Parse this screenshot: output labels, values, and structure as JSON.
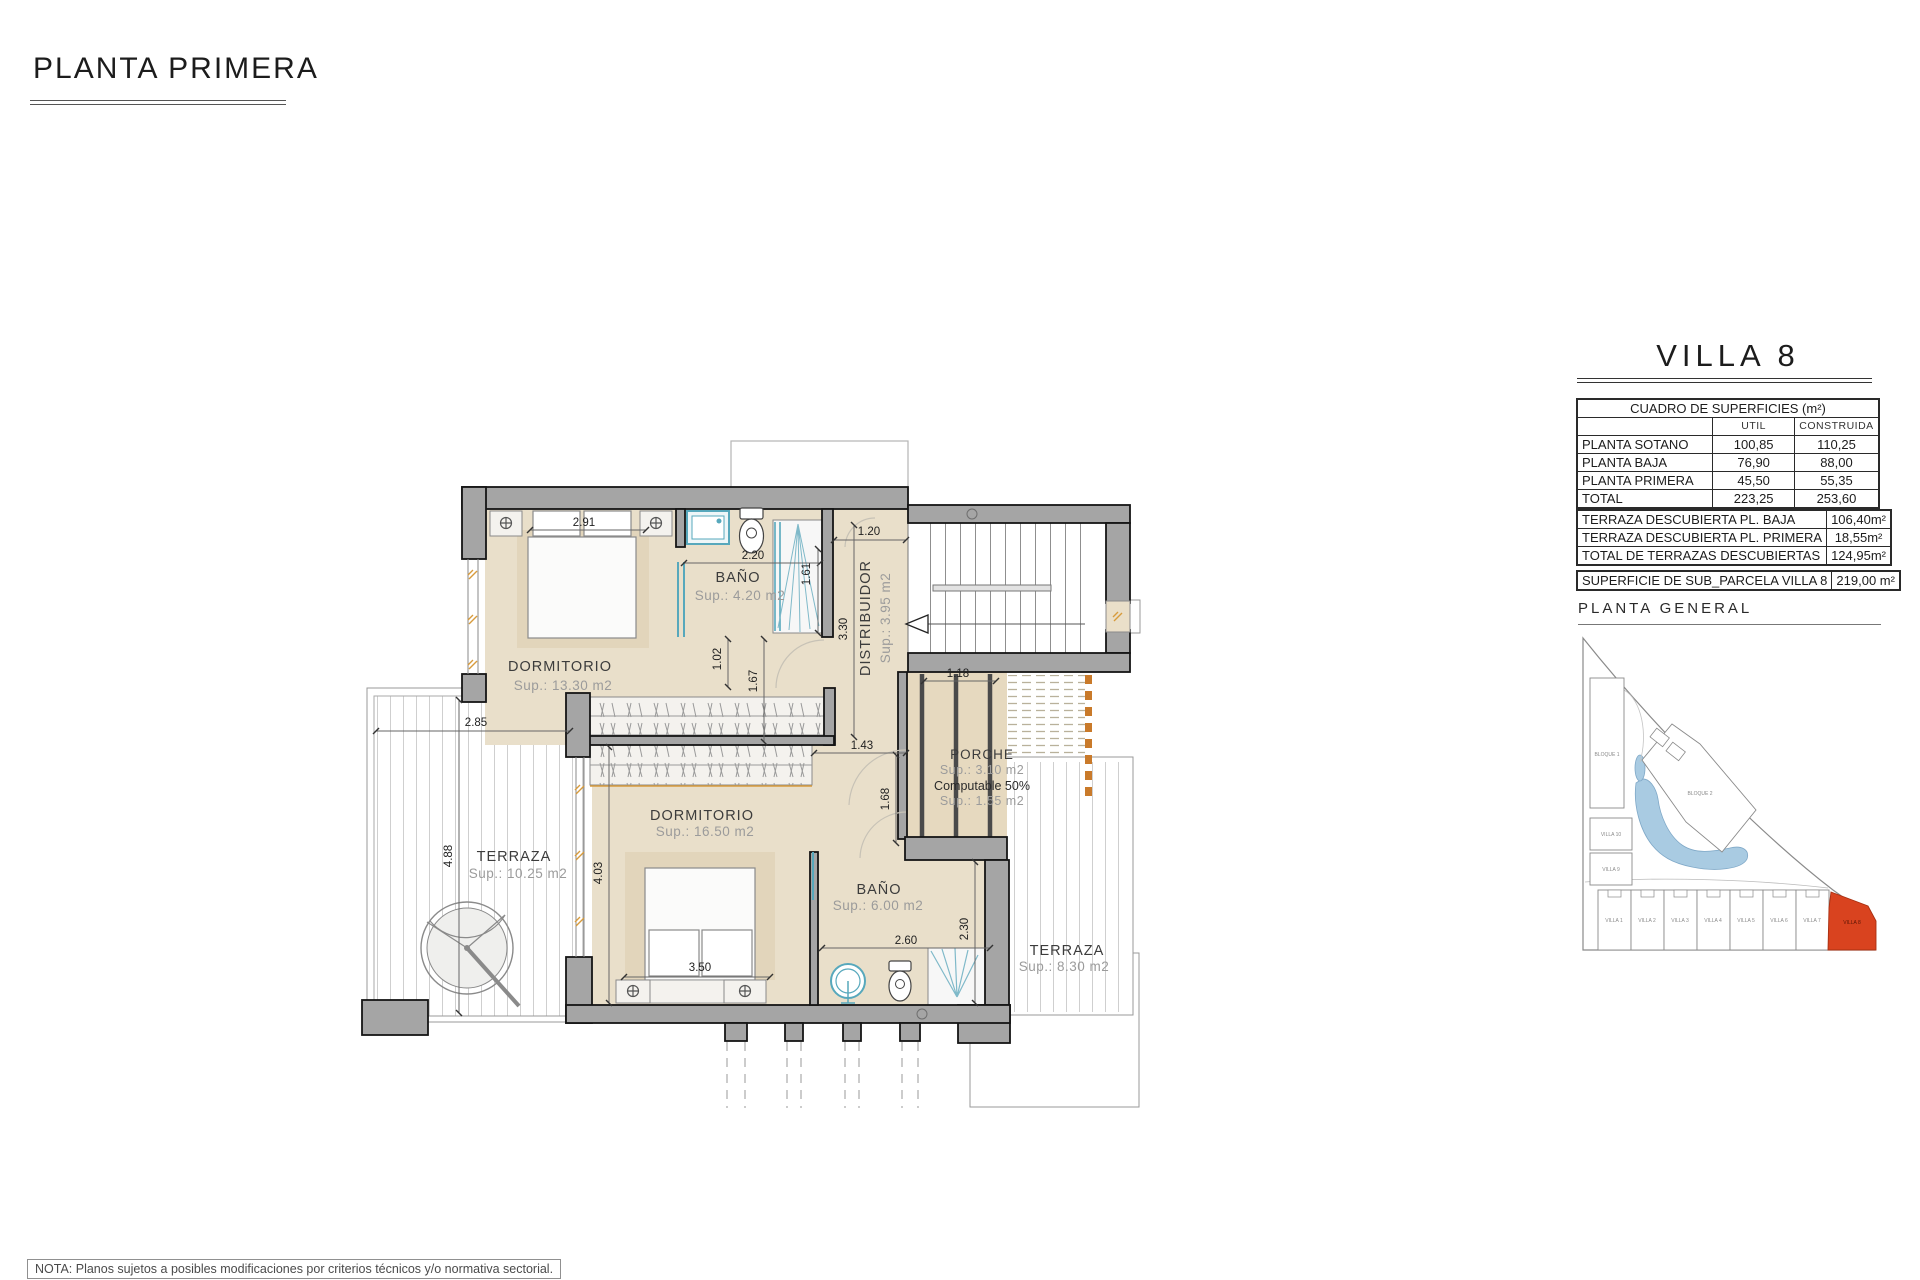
{
  "page": {
    "title": "PLANTA PRIMERA",
    "note": "NOTA: Planos sujetos a posibles modificaciones por criterios técnicos y/o normativa sectorial."
  },
  "panel": {
    "villa_title": "VILLA 8",
    "surfaces_table": {
      "title": "CUADRO DE SUPERFICIES (m²)",
      "col_util": "UTIL",
      "col_construida": "CONSTRUIDA",
      "rows": [
        {
          "label": "PLANTA SOTANO",
          "util": "100,85",
          "construida": "110,25"
        },
        {
          "label": "PLANTA BAJA",
          "util": "76,90",
          "construida": "88,00"
        },
        {
          "label": "PLANTA PRIMERA",
          "util": "45,50",
          "construida": "55,35"
        },
        {
          "label": "TOTAL",
          "util": "223,25",
          "construida": "253,60"
        }
      ]
    },
    "terraces_table": {
      "rows": [
        {
          "label": "TERRAZA DESCUBIERTA PL. BAJA",
          "value": "106,40m²"
        },
        {
          "label": "TERRAZA DESCUBIERTA PL. PRIMERA",
          "value": "18,55m²"
        },
        {
          "label": "TOTAL DE TERRAZAS DESCUBIERTAS",
          "value": "124,95m²"
        }
      ]
    },
    "parcel_table": {
      "label": "SUPERFICIE DE SUB_PARCELA VILLA 8",
      "value": "219,00 m²"
    },
    "general_title": "PLANTA  GENERAL",
    "site": {
      "bloque1": "BLOQUE 1",
      "bloque2": "BLOQUE 2",
      "villa10": "VILLA 10",
      "villa9": "VILLA 9",
      "villas_row": [
        "VILLA 1",
        "VILLA 2",
        "VILLA 3",
        "VILLA 4",
        "VILLA 5",
        "VILLA 6",
        "VILLA 7"
      ],
      "villa8_label": "VILLA 8",
      "highlight_color": "#d9431f"
    }
  },
  "floorplan": {
    "rooms": {
      "dorm1": {
        "name": "DORMITORIO",
        "sup": "Sup.: 13.30  m2"
      },
      "bath1": {
        "name": "BAÑO",
        "sup": "Sup.: 4.20   m2"
      },
      "distrib": {
        "name": "DISTRIBUIDOR",
        "sup": "Sup.: 3.95  m2"
      },
      "dorm2": {
        "name": "DORMITORIO",
        "sup": "Sup.: 16.50  m2"
      },
      "bath2": {
        "name": "BAÑO",
        "sup": "Sup.: 6.00   m2"
      },
      "terraza1": {
        "name": "TERRAZA",
        "sup": "Sup.: 10.25  m2"
      },
      "terraza2": {
        "name": "TERRAZA",
        "sup": "Sup.: 8.30   m2"
      },
      "porche": {
        "name": "PORCHE",
        "sup": "Sup.: 3.10   m2",
        "line2": "Computable 50%",
        "sup2": "Sup.: 1.55   m2"
      }
    },
    "dims": {
      "d291": "2.91",
      "d220": "2.20",
      "d120": "1.20",
      "d161": "1.61",
      "d330": "3.30",
      "d102": "1.02",
      "d167": "1.67",
      "d285": "2.85",
      "d143": "1.43",
      "d118": "1.18",
      "d168": "1.68",
      "d488": "4.88",
      "d403": "4.03",
      "d350": "3.50",
      "d260": "2.60",
      "d230": "2.30"
    }
  }
}
